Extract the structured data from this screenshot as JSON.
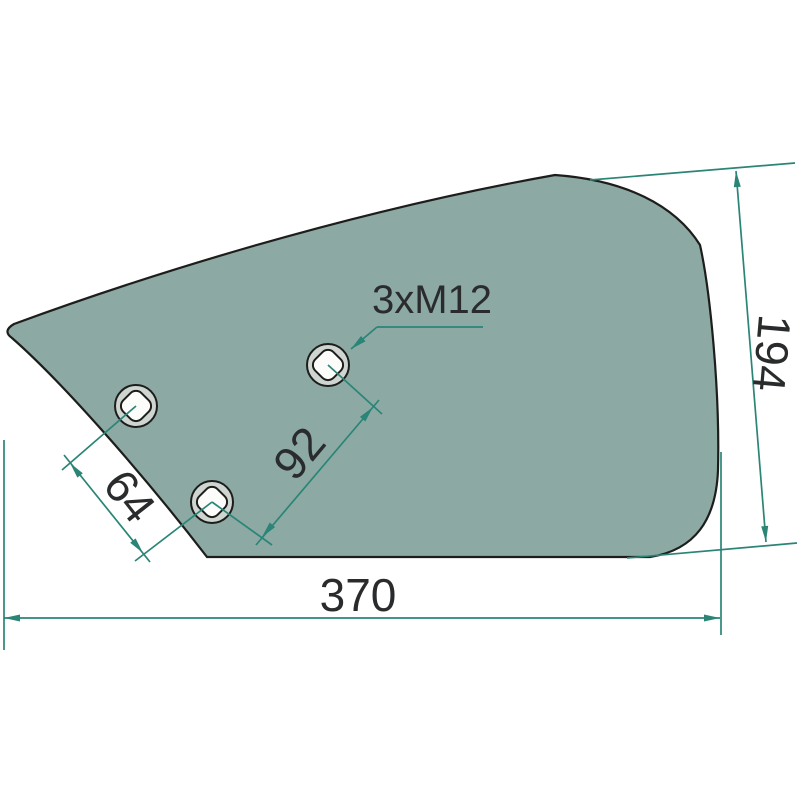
{
  "drawing": {
    "type": "technical-drawing",
    "part": "plough-share-wing-plate",
    "hole_label": "3xM12",
    "dim_width": "370",
    "dim_height": "194",
    "dim_hole_spacing_small": "64",
    "dim_hole_spacing_large": "92",
    "hole_count": 3,
    "colors": {
      "plate_fill": "#8CA9A4",
      "outline": "#1D1D1B",
      "dimension_line": "#2A8577",
      "hole_ring": "#CFD5D0",
      "hole_inner": "#FCFCFA",
      "text": "#2A2B2C",
      "background": "#FFFFFF"
    }
  }
}
